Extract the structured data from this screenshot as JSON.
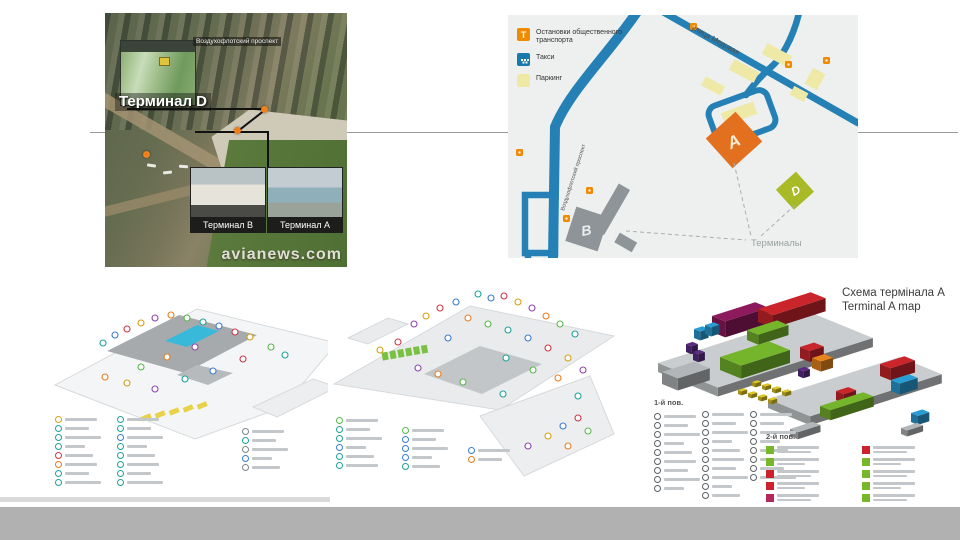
{
  "aerial": {
    "street_sign": "Воздухофлотский проспект",
    "terminal_d": "Терминал D",
    "terminal_b": "Терминал B",
    "terminal_a": "Терминал A",
    "watermark": "avianews.com"
  },
  "map": {
    "legend": [
      {
        "name": "transport-stop",
        "color": "#f08a00",
        "label_line1": "Остановки общественного",
        "label_line2": "транспорта"
      },
      {
        "name": "taxi",
        "color": "#1879ad",
        "label_line1": "Такси",
        "label_line2": ""
      },
      {
        "name": "parking",
        "color": "#f0e9a6",
        "label_line1": "Паркинг",
        "label_line2": ""
      }
    ],
    "street_medovaya": "улица Медовая",
    "street_prospekt": "Воздухофлотский проспект",
    "terminals_label": "Терминалы",
    "building_a": "А",
    "building_b": "В",
    "building_d": "D"
  },
  "terminal_map": {
    "title_line1": "Схема термінала А",
    "title_line2": "Terminal A map",
    "floor1_header": "1-й пов.",
    "floor2_header": "2-й пов."
  },
  "palette": {
    "icon_palette": [
      "#1fa29b",
      "#3a7bd5",
      "#c8374a",
      "#d4a017",
      "#8e44ad",
      "#e67e22",
      "#57b94c"
    ],
    "terminal_colors": {
      "magenta": "#8e1a5e",
      "red": "#c9252b",
      "green": "#74b52c",
      "blue": "#2a9cd4",
      "orange": "#e8861e",
      "purple": "#5b2b82",
      "yellow": "#dfc723",
      "gray": "#b2b6b8",
      "base": "#c9cdcf"
    },
    "road_blue": "#2581b5",
    "footer_gray": "#b1b1b1"
  },
  "skeletons": {
    "planA": {
      "cols": [
        {
          "x": 0,
          "y": 0,
          "rows": 8,
          "palette": [
            "#d4a017",
            "#1fa29b",
            "#1fa29b",
            "#1fa29b",
            "#c8374a",
            "#e67e22",
            "#1fa29b",
            "#1fa29b"
          ]
        },
        {
          "x": 62,
          "y": 0,
          "rows": 8,
          "palette": [
            "#1fa29b",
            "#1fa29b",
            "#3a7bd5",
            "#1fa29b",
            "#1fa29b",
            "#1fa29b",
            "#1fa29b",
            "#1fa29b"
          ]
        },
        {
          "x": 187,
          "y": 12,
          "rows": 5,
          "palette": [
            "#7e858a",
            "#1fa29b",
            "#7e858a",
            "#3a7bd5",
            "#7e858a"
          ]
        }
      ]
    },
    "planB": {
      "cols": [
        {
          "x": 0,
          "y": 0,
          "rows": 6,
          "palette": [
            "#57b94c",
            "#1fa29b",
            "#1fa29b",
            "#3a7bd5",
            "#1fa29b",
            "#1fa29b"
          ]
        },
        {
          "x": 66,
          "y": 10,
          "rows": 5,
          "palette": [
            "#57b94c",
            "#3a7bd5",
            "#3a7bd5",
            "#3a7bd5",
            "#1fa29b"
          ]
        },
        {
          "x": 132,
          "y": 30,
          "rows": 2,
          "palette": [
            "#3a7bd5",
            "#e67e22"
          ]
        }
      ]
    },
    "planC1": {
      "cols": [
        {
          "x": 0,
          "y": 14,
          "rows": 9,
          "palette": [
            "#5b6166"
          ]
        },
        {
          "x": 48,
          "y": 12,
          "rows": 10,
          "palette": [
            "#5b6166"
          ]
        },
        {
          "x": 96,
          "y": 12,
          "rows": 8,
          "palette": [
            "#5b6166"
          ]
        }
      ]
    }
  },
  "floor2_legend": {
    "col1": [
      "#76b82a",
      "#76b82a",
      "#cc2229",
      "#cc2229",
      "#b5285a"
    ],
    "col2": [
      "#cc2229",
      "#76b82a",
      "#76b82a",
      "#76b82a",
      "#76b82a"
    ]
  }
}
